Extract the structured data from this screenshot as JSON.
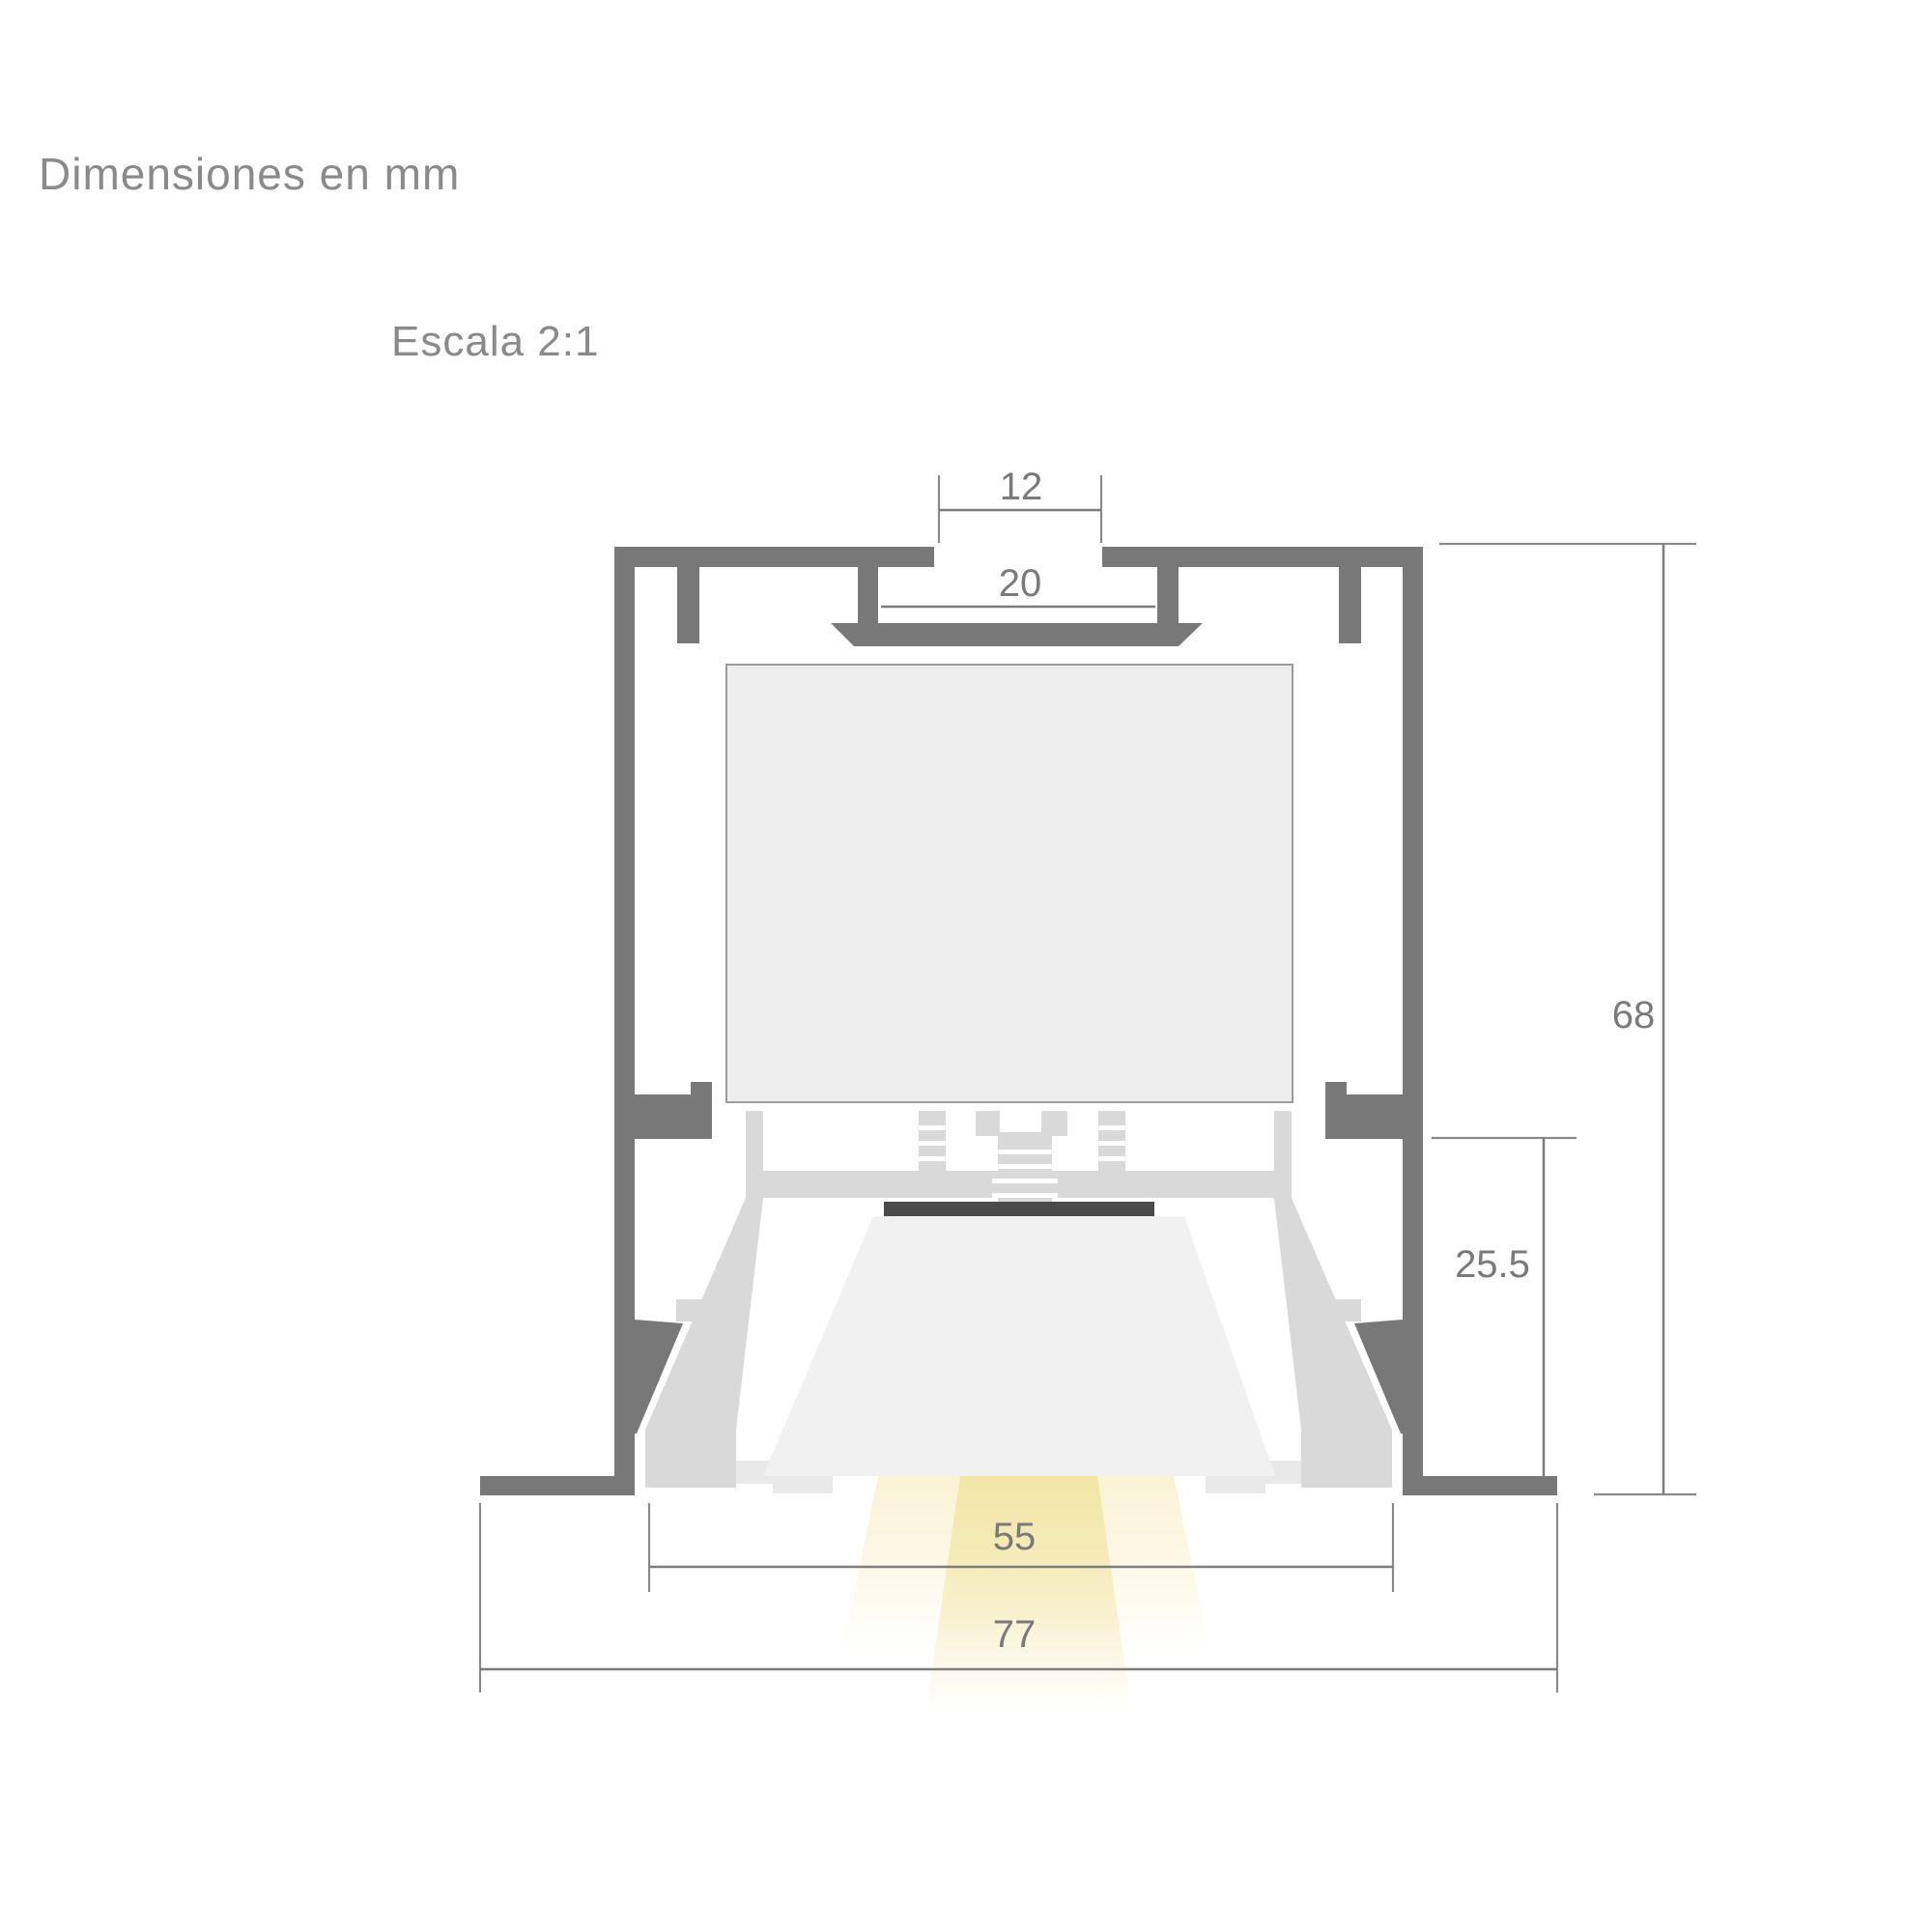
{
  "title": "Dimensiones en mm",
  "scale_label": "Escala 2:1",
  "unit": "mm",
  "dims": {
    "slot_width": "12",
    "channel_width": "20",
    "overall_height": "68",
    "recess_depth": "25.5",
    "opening_width": "55",
    "overall_width": "77"
  },
  "colors": {
    "profile_gray": "#787878",
    "dimension_gray": "#7d7d7d",
    "label_gray": "#8a8a8a",
    "reflector_gray": "#d9d9d9",
    "led_board_gray": "#ededed",
    "diffuser_gray": "#f1f1f1",
    "led_strip_dark": "#4a4a4a",
    "beam_inner_yellow": "#f2e5a4",
    "beam_outer_yellow": "#f8efc6",
    "background": "#ffffff"
  }
}
